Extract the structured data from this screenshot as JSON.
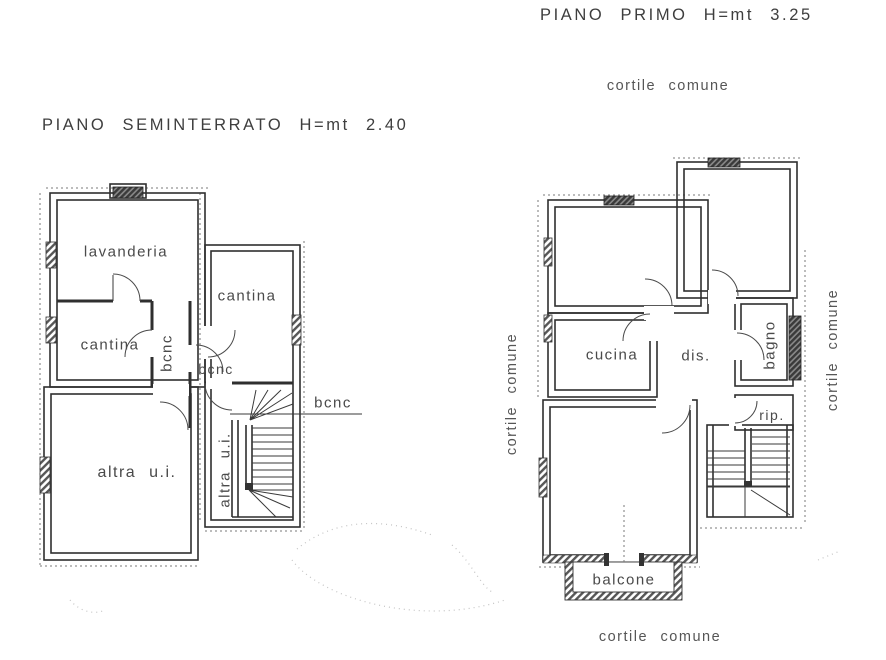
{
  "plans": {
    "seminterrato": {
      "title": "PIANO SEMINTERRATO H=mt 2.40",
      "rooms": {
        "lavanderia": "lavanderia",
        "cantina_left": "cantina",
        "cantina_right": "cantina",
        "bcnc_corridor": "bcnc",
        "bcnc_entry": "bcnc",
        "bcnc_callout": "bcnc",
        "altra_ui": "altra u.i.",
        "altra_ui_stair": "altra u.i."
      }
    },
    "primo": {
      "title": "PIANO PRIMO H=mt 3.25",
      "rooms": {
        "cucina": "cucina",
        "dis": "dis.",
        "bagno": "bagno",
        "rip": "rip.",
        "balcone": "balcone"
      },
      "courtyards": {
        "top": "cortile comune",
        "left": "cortile comune",
        "right": "cortile comune",
        "bottom": "cortile comune"
      }
    }
  },
  "colors": {
    "ink": "#2f2f2f",
    "text": "#4a4a4a",
    "paper": "#ffffff"
  }
}
